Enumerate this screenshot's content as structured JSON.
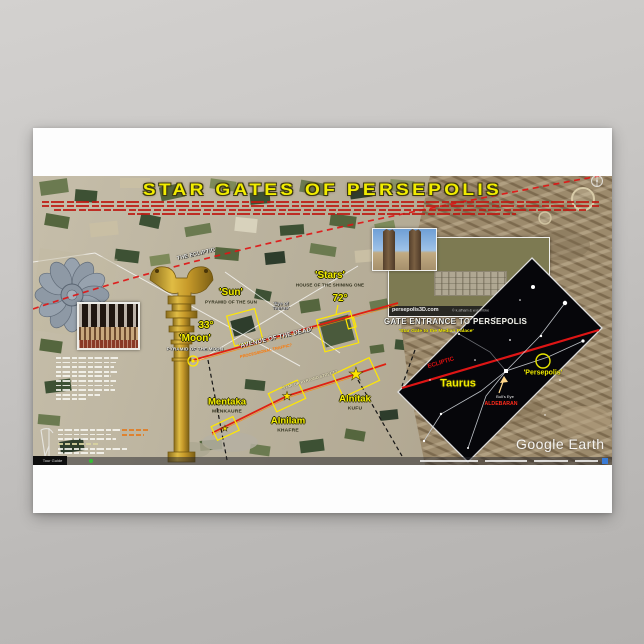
{
  "poster": {
    "title": "STAR GATES OF PERSEPOLIS",
    "colors": {
      "accent_yellow": "#f2ec00",
      "annotation_red": "#e01515",
      "orange": "#ff8800",
      "gold": "#c79a2a"
    },
    "map": {
      "ecliptic_label": "THE ECLIPTIC",
      "sun": "'Sun'",
      "sun_sub": "PYRAMID OF THE SUN",
      "moon": "'Moon'",
      "moon_sub": "PYRAMID OF THE MOON",
      "angle_moon": "33°",
      "angle_72": "72°",
      "stars": "'Stars'",
      "stars_sub": "HOUSE OF THE SHINING ONE",
      "eye_of_taurus": "'Eye of\nTaurus'",
      "avenue": "'AVENUE OF THE DEAD'",
      "avenue_sub": "PROCESSIONAL TRAFFIC?",
      "street": "STAR OR PYRAMID STREET?",
      "mentaka": "Mentaka",
      "mentaka_sub": "MENKAURE",
      "alnilam": "Alnilam",
      "alnilam_sub": "KHAFRE",
      "alnitak": "Alnitak",
      "alnitak_sub": "KUFU"
    },
    "gate": {
      "title": "GATE ENTRANCE TO PERSEPOLIS",
      "subtitle": "'Star Gate to the Median Palace'",
      "photo_credit": "persepolis3D.com",
      "photo_credit_owner": "© k.afham & w.gambke"
    },
    "star_chart": {
      "constellation": "Taurus",
      "ecliptic": "ECLIPTIC",
      "persepolis": "'Persepolis'",
      "bulls_eye": "Bull's Eye",
      "aldebaran": "ALDEBARAN",
      "tau": "Tau"
    },
    "google_earth": {
      "watermark": "Google Earth",
      "tour_guide": "Tour Guide"
    }
  }
}
